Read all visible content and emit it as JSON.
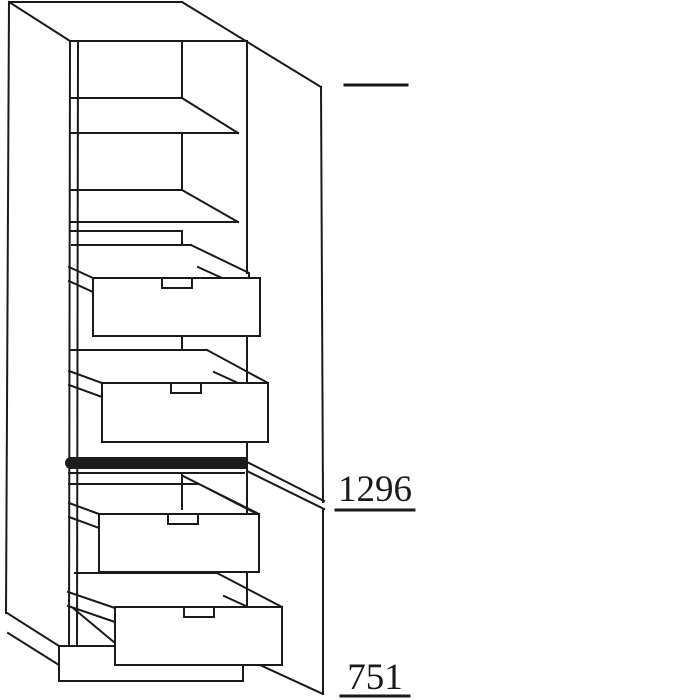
{
  "diagram": {
    "type": "cabinet-technical-line-drawing",
    "dimensions": {
      "upper_front_height": "1296",
      "lower_front_height": "751"
    },
    "colors": {
      "line": "#1a1a1a",
      "background": "#ffffff",
      "handle_bar": "#1c1c1c"
    }
  }
}
